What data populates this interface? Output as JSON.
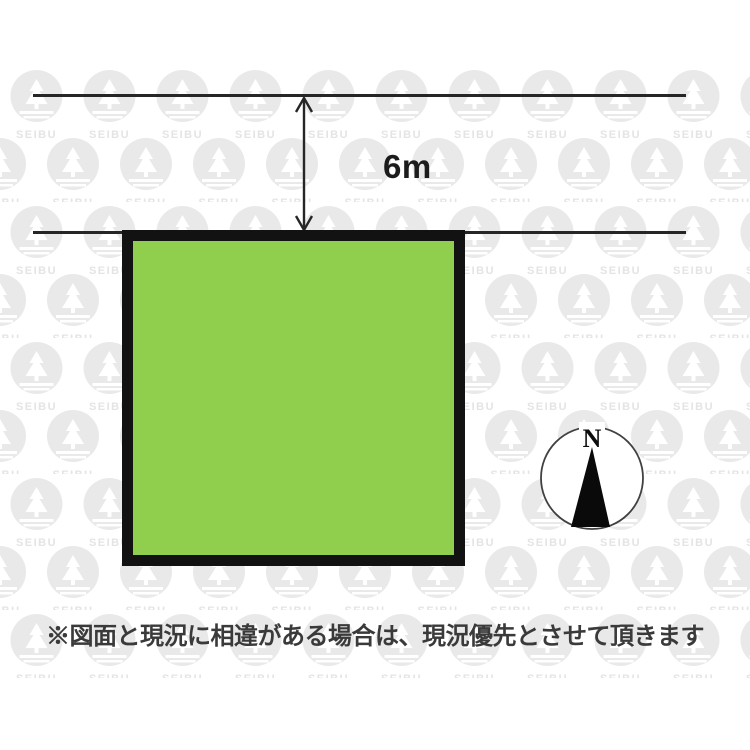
{
  "diagram": {
    "title": "land-plot-layout-drawing",
    "road": {
      "width_label": "6m"
    },
    "compass": {
      "north_label": "N"
    },
    "disclaimer": {
      "text": "※図面と現況に相違がある場合は、現況優先とさせて頂きます"
    },
    "watermark": {
      "brand_text": "SEIBU"
    }
  },
  "colors": {
    "plot_fill": "#90ce4e",
    "plot_border": "#121212",
    "line_color": "#262626",
    "text_color": "#1c1c1c",
    "disclaimer_color": "#3a3a3a",
    "watermark_fill": "#e9e9e9",
    "watermark_text": "#e4e4e4"
  }
}
